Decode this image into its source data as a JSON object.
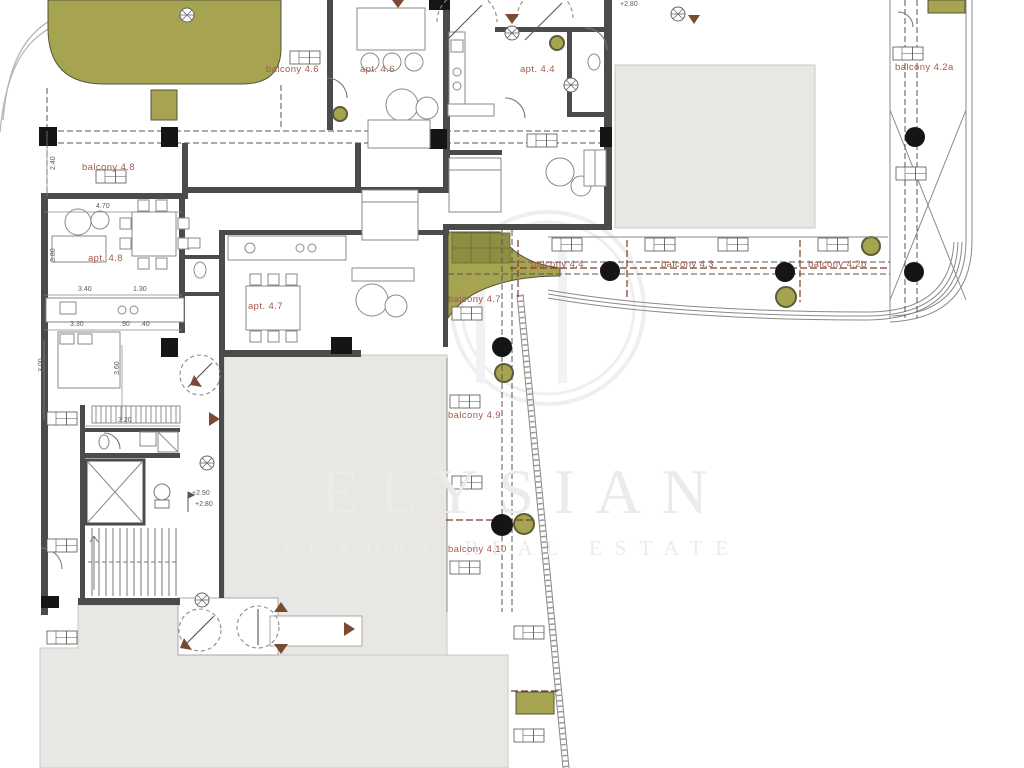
{
  "watermark": {
    "brand": "ELYSIAN",
    "tagline": "LUXURY REAL ESTATE"
  },
  "plan": {
    "apartment_labels": [
      {
        "text": "apt. 4.6"
      },
      {
        "text": "apt. 4.4"
      },
      {
        "text": "apt. 4.7"
      },
      {
        "text": "apt. 4.8"
      }
    ],
    "balcony_labels": [
      {
        "text": "balcony 4.6"
      },
      {
        "text": "balcony 4.8"
      },
      {
        "text": "balcony 4.4"
      },
      {
        "text": "balcony 4.3"
      },
      {
        "text": "balcony 4.2b"
      },
      {
        "text": "balcony 4.2a"
      },
      {
        "text": "balcony 4.7"
      },
      {
        "text": "balcony 4.9"
      },
      {
        "text": "balcony 4.10"
      }
    ],
    "dimension_labels": [
      {
        "text": "2.40"
      },
      {
        "text": "3.80"
      },
      {
        "text": "4.70"
      },
      {
        "text": "3.40"
      },
      {
        "text": "1.30"
      },
      {
        "text": "3.30"
      },
      {
        "text": ".90"
      },
      {
        "text": ".40"
      },
      {
        "text": "3.00"
      },
      {
        "text": "3.60"
      },
      {
        "text": "3.20"
      }
    ],
    "level_labels": [
      {
        "text": "+2.80"
      },
      {
        "text": "+2.90"
      },
      {
        "text": "+2.80"
      }
    ]
  },
  "colors": {
    "label_red": "#a2594b",
    "wall": "#4b4b49",
    "green": "#a6a451",
    "neighbor_gray": "#e8e7e4",
    "dash_red": "#7c3a2c",
    "triangle_brown": "#7b4a32",
    "watermark": "#ebebeb"
  }
}
